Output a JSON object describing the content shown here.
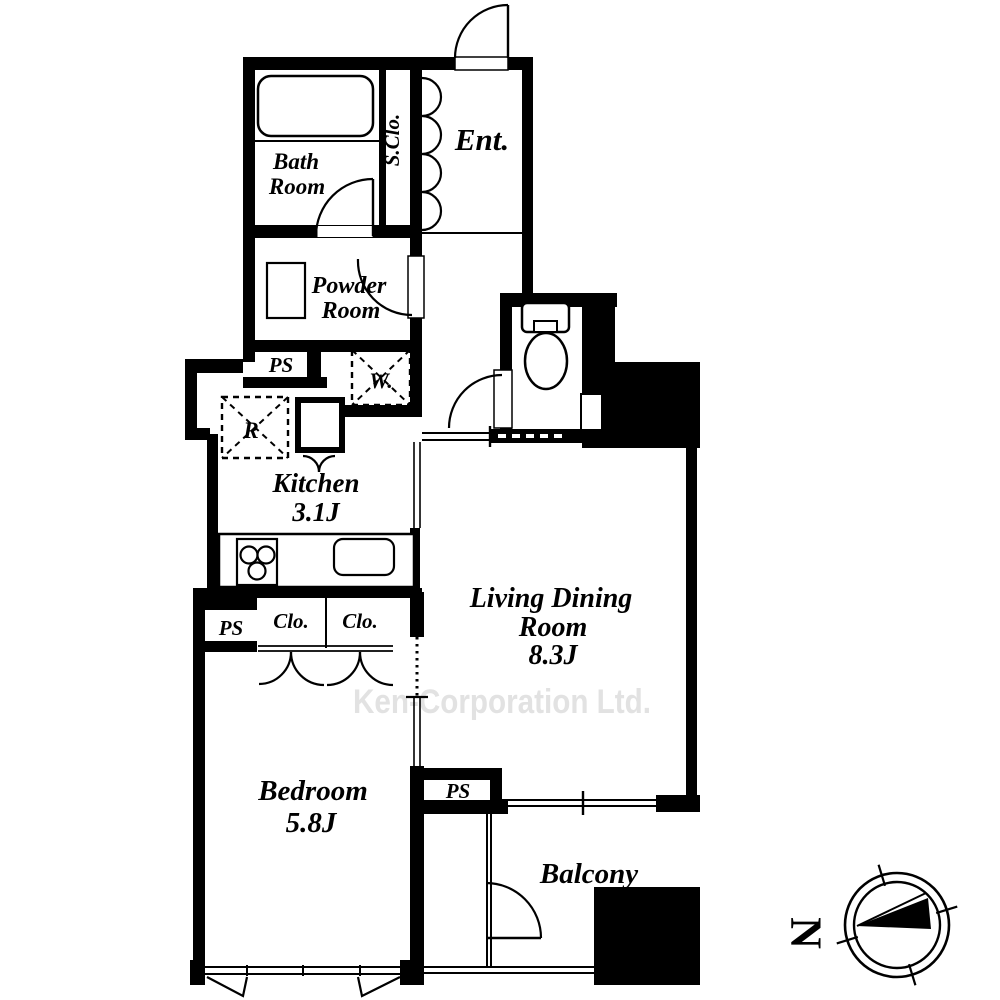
{
  "rooms": {
    "bath_line1": "Bath",
    "bath_line2": "Room",
    "shoe_closet": "S.Clo.",
    "entrance": "Ent.",
    "powder_line1": "Powder",
    "powder_line2": "Room",
    "kitchen_name": "Kitchen",
    "kitchen_size": "3.1J",
    "living_line1": "Living Dining",
    "living_line2": "Room",
    "living_size": "8.3J",
    "bedroom_name": "Bedroom",
    "bedroom_size": "5.8J",
    "balcony": "Balcony",
    "closet1": "Clo.",
    "closet2": "Clo."
  },
  "utility": {
    "pipe_space": "PS",
    "washer": "W.",
    "refrigerator": "R"
  },
  "watermark": "Ken-Corporation Ltd.",
  "watermark_color": "#e2e2e2",
  "line_color": "#000000",
  "compass": {
    "north": "N"
  }
}
